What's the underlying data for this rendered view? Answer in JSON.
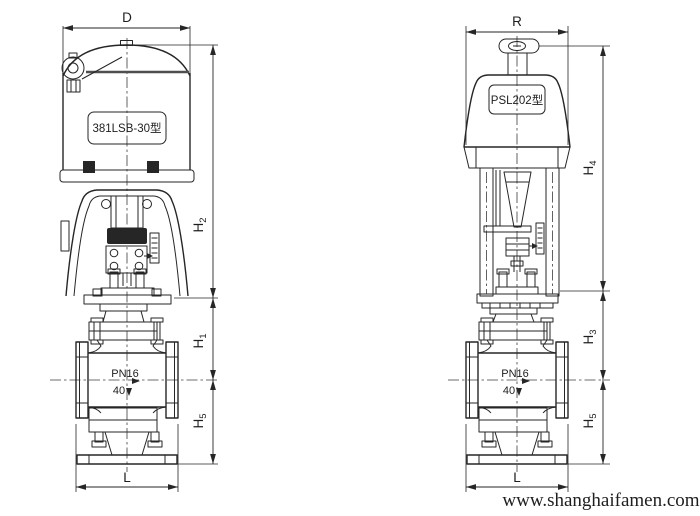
{
  "drawing": {
    "left_view": {
      "actuator_model": "381LSB-30型",
      "dim_top_width": "D",
      "dim_h_upper": {
        "base": "H",
        "sub": "2"
      },
      "dim_h_mid": {
        "base": "H",
        "sub": "1"
      },
      "dim_h_lower": {
        "base": "H",
        "sub": "5"
      },
      "dim_length": "L",
      "pressure_class": "PN16",
      "nominal_size": "40"
    },
    "right_view": {
      "actuator_model": "PSL202型",
      "dim_top_width": "R",
      "dim_h_upper": {
        "base": "H",
        "sub": "4"
      },
      "dim_h_mid": {
        "base": "H",
        "sub": "3"
      },
      "dim_h_lower": {
        "base": "H",
        "sub": "5"
      },
      "dim_length": "L",
      "pressure_class": "PN16",
      "nominal_size": "40"
    },
    "watermark_url": "www.shanghaifamen.com"
  },
  "colors": {
    "line": "#262626",
    "watermark": "#8e9b94",
    "background": "#ffffff"
  }
}
